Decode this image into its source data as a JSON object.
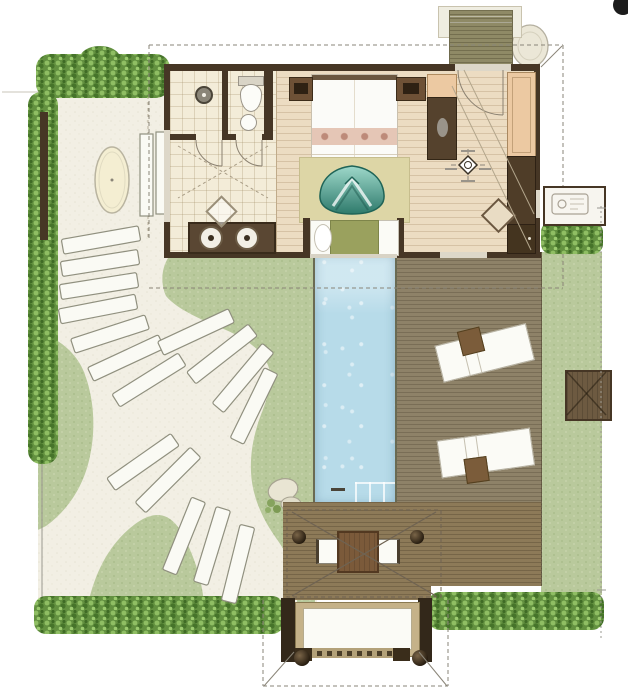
{
  "meta": {
    "type": "architectural-floor-plan",
    "subject": "pool villa with garden, lap pool and sun deck",
    "visible_text": []
  },
  "palette": {
    "paper": "#ffffff",
    "sand": "#f2efe4",
    "tile": "#f3ecd8",
    "wood": "#ecdcc2",
    "wall": "#463625",
    "wall_glass": "#ddd7c8",
    "lawn": "#b9c99c",
    "lawn_shade": "#a9bc89",
    "hedge": "#639140",
    "hedge_light": "#8fbe63",
    "hedge_dark": "#46742a",
    "pool": "#b7dbe9",
    "deck_grey": "#8e8268",
    "deck_brown": "#8d7a58",
    "deck_entry": "#8f8a66",
    "furn_dark": "#55422d",
    "furn_tan": "#ecc9a2",
    "white_soft": "#fbfbf6",
    "teal": "#5fae9d",
    "teal_dark": "#1f6457",
    "rug": "#ddd6a6",
    "bench_olive": "#9aa15e",
    "table_brown": "#7b5a3a",
    "gate_tan": "#c5b289",
    "line_grey": "#9a9890",
    "stone_line": "#90907f"
  },
  "features": {
    "areas": [
      "outdoor-courtyard",
      "stepping-stone-path",
      "lawn-garden",
      "bathroom",
      "shower-stall",
      "wc-stall",
      "bedroom",
      "dressing-area",
      "entry-deck",
      "utility-room",
      "lap-pool",
      "sun-deck",
      "dining-pavilion",
      "entry-gate"
    ],
    "symbols": [
      "shower-head-icon",
      "toilet-icon",
      "basin-icon",
      "level-marker-icon",
      "north-mark-icon",
      "outdoor-shower-icon",
      "door-swing-arc",
      "roof-overhang-dashed-line"
    ],
    "furniture": [
      "double-bed",
      "nightstand",
      "wardrobe",
      "closet",
      "teal-ottoman-tub",
      "window-daybed",
      "sun-lounger",
      "towel-block",
      "dining-table",
      "dining-chair",
      "stone-bath-oval",
      "garden-bench"
    ]
  }
}
